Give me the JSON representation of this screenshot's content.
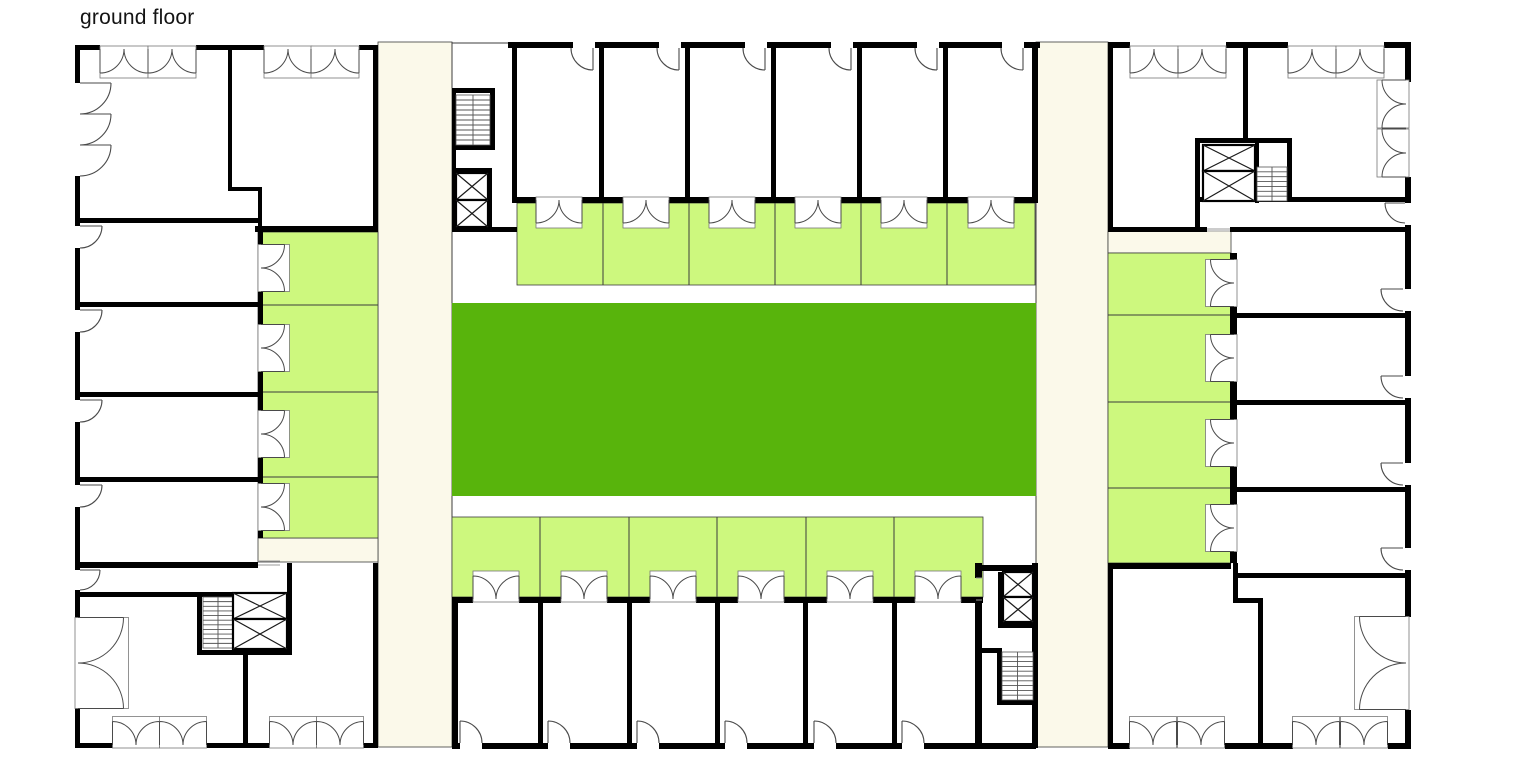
{
  "title": "ground floor",
  "canvas": {
    "width": 1536,
    "height": 780
  },
  "colors": {
    "street": "#fbf9ea",
    "terrace": "#cdf87e",
    "courtyard": "#58b40c",
    "wall": "#000000",
    "thin": "#3c3c3c",
    "door": "#4a4a4a",
    "sill": "#999999",
    "stair": "#555555",
    "title_text": "#141414"
  },
  "plan": {
    "fills": [
      [
        378,
        42,
        74,
        705,
        "street",
        1
      ],
      [
        1036,
        42,
        72,
        705,
        "street",
        1
      ],
      [
        258,
        538,
        120,
        24,
        "street",
        1
      ],
      [
        1108,
        231,
        123,
        22,
        "street",
        1
      ],
      [
        258,
        232,
        120,
        306,
        "terrace",
        1
      ],
      [
        1108,
        253,
        123,
        310,
        "terrace",
        1
      ],
      [
        517,
        203,
        518,
        82,
        "terrace",
        1
      ],
      [
        452,
        517,
        531,
        80,
        "terrace",
        1
      ],
      [
        452,
        303,
        584,
        193,
        "courtyard",
        0
      ]
    ],
    "thin_lines": [
      [
        258,
        305,
        378,
        305
      ],
      [
        258,
        392,
        378,
        392
      ],
      [
        258,
        477,
        378,
        477
      ],
      [
        1108,
        315,
        1231,
        315
      ],
      [
        1108,
        402,
        1231,
        402
      ],
      [
        1108,
        488,
        1231,
        488
      ],
      [
        603,
        203,
        603,
        285
      ],
      [
        689,
        203,
        689,
        285
      ],
      [
        775,
        203,
        775,
        285
      ],
      [
        861,
        203,
        861,
        285
      ],
      [
        947,
        203,
        947,
        285
      ],
      [
        540,
        517,
        540,
        597
      ],
      [
        629,
        517,
        629,
        597
      ],
      [
        717,
        517,
        717,
        597
      ],
      [
        806,
        517,
        806,
        597
      ],
      [
        894,
        517,
        894,
        597
      ],
      [
        452,
        42,
        452,
        88
      ],
      [
        452,
        232,
        452,
        303
      ],
      [
        452,
        496,
        452,
        517
      ],
      [
        1036,
        203,
        1036,
        303
      ],
      [
        1036,
        496,
        1036,
        563
      ],
      [
        452,
        43,
        512,
        43
      ]
    ],
    "walls": [
      [
        75,
        45,
        25,
        5
      ],
      [
        196,
        45,
        68,
        5
      ],
      [
        359,
        45,
        19,
        5
      ],
      [
        75,
        45,
        5,
        38
      ],
      [
        75,
        176,
        5,
        50
      ],
      [
        75,
        248,
        5,
        62
      ],
      [
        75,
        332,
        5,
        68
      ],
      [
        75,
        422,
        5,
        63
      ],
      [
        75,
        507,
        5,
        63
      ],
      [
        75,
        590,
        5,
        28
      ],
      [
        75,
        708,
        5,
        40
      ],
      [
        373,
        45,
        5,
        187
      ],
      [
        373,
        563,
        5,
        185
      ],
      [
        75,
        743,
        38,
        5
      ],
      [
        207,
        743,
        63,
        5
      ],
      [
        363,
        743,
        15,
        5
      ],
      [
        228,
        45,
        4,
        142
      ],
      [
        228,
        187,
        34,
        4
      ],
      [
        258,
        187,
        4,
        45
      ],
      [
        75,
        218,
        183,
        5
      ],
      [
        75,
        302,
        183,
        5
      ],
      [
        75,
        392,
        183,
        5
      ],
      [
        75,
        477,
        183,
        5
      ],
      [
        75,
        562,
        183,
        6
      ],
      [
        255,
        226,
        123,
        6
      ],
      [
        258,
        232,
        5,
        13
      ],
      [
        258,
        292,
        5,
        33
      ],
      [
        258,
        372,
        5,
        39
      ],
      [
        258,
        458,
        5,
        26
      ],
      [
        258,
        531,
        5,
        7
      ],
      [
        75,
        592,
        217,
        5
      ],
      [
        197,
        597,
        5,
        58
      ],
      [
        287,
        563,
        5,
        92
      ],
      [
        197,
        650,
        95,
        5
      ],
      [
        243,
        655,
        5,
        93
      ],
      [
        508,
        42,
        65,
        6
      ],
      [
        595,
        42,
        64,
        6
      ],
      [
        681,
        42,
        64,
        6
      ],
      [
        767,
        42,
        64,
        6
      ],
      [
        853,
        42,
        64,
        6
      ],
      [
        939,
        42,
        63,
        6
      ],
      [
        1024,
        42,
        16,
        6
      ],
      [
        512,
        42,
        5,
        161
      ],
      [
        1032,
        42,
        6,
        161
      ],
      [
        599,
        48,
        5,
        149
      ],
      [
        685,
        48,
        5,
        149
      ],
      [
        771,
        48,
        5,
        149
      ],
      [
        857,
        48,
        5,
        149
      ],
      [
        943,
        48,
        5,
        149
      ],
      [
        512,
        197,
        24,
        6
      ],
      [
        582,
        197,
        42,
        6
      ],
      [
        669,
        197,
        41,
        6
      ],
      [
        755,
        197,
        41,
        6
      ],
      [
        841,
        197,
        41,
        6
      ],
      [
        927,
        197,
        41,
        6
      ],
      [
        1014,
        197,
        24,
        6
      ],
      [
        452,
        88,
        38,
        5
      ],
      [
        452,
        88,
        4,
        144
      ],
      [
        490,
        88,
        5,
        62
      ],
      [
        456,
        145,
        39,
        5
      ],
      [
        452,
        168,
        40,
        4
      ],
      [
        488,
        168,
        4,
        64
      ],
      [
        452,
        227,
        65,
        5
      ],
      [
        538,
        603,
        5,
        142
      ],
      [
        627,
        603,
        5,
        142
      ],
      [
        715,
        603,
        5,
        142
      ],
      [
        803,
        603,
        5,
        142
      ],
      [
        892,
        603,
        5,
        142
      ],
      [
        452,
        597,
        21,
        6
      ],
      [
        519,
        597,
        42,
        6
      ],
      [
        607,
        597,
        43,
        6
      ],
      [
        696,
        597,
        42,
        6
      ],
      [
        784,
        597,
        43,
        6
      ],
      [
        873,
        597,
        42,
        6
      ],
      [
        961,
        597,
        22,
        6
      ],
      [
        452,
        597,
        6,
        151
      ],
      [
        452,
        743,
        8,
        6
      ],
      [
        482,
        743,
        66,
        6
      ],
      [
        570,
        743,
        67,
        6
      ],
      [
        659,
        743,
        66,
        6
      ],
      [
        747,
        743,
        67,
        6
      ],
      [
        836,
        743,
        66,
        6
      ],
      [
        924,
        743,
        112,
        6
      ],
      [
        975,
        563,
        7,
        15
      ],
      [
        975,
        600,
        7,
        148
      ],
      [
        975,
        565,
        62,
        6
      ],
      [
        998,
        572,
        5,
        56
      ],
      [
        998,
        623,
        39,
        5
      ],
      [
        997,
        648,
        5,
        57
      ],
      [
        978,
        648,
        24,
        5
      ],
      [
        997,
        700,
        40,
        5
      ],
      [
        1032,
        563,
        6,
        185
      ],
      [
        1108,
        42,
        22,
        6
      ],
      [
        1226,
        42,
        62,
        6
      ],
      [
        1384,
        42,
        26,
        6
      ],
      [
        1108,
        42,
        5,
        190
      ],
      [
        1108,
        563,
        5,
        185
      ],
      [
        1405,
        42,
        6,
        40
      ],
      [
        1405,
        177,
        6,
        26
      ],
      [
        1405,
        225,
        6,
        64
      ],
      [
        1405,
        311,
        6,
        65
      ],
      [
        1405,
        398,
        6,
        65
      ],
      [
        1405,
        485,
        6,
        63
      ],
      [
        1405,
        570,
        6,
        47
      ],
      [
        1405,
        710,
        6,
        38
      ],
      [
        1108,
        743,
        22,
        6
      ],
      [
        1225,
        743,
        68,
        6
      ],
      [
        1388,
        743,
        23,
        6
      ],
      [
        1243,
        42,
        5,
        96
      ],
      [
        1200,
        138,
        90,
        5
      ],
      [
        1195,
        138,
        5,
        94
      ],
      [
        1255,
        143,
        4,
        60
      ],
      [
        1287,
        138,
        5,
        64
      ],
      [
        1195,
        197,
        215,
        5
      ],
      [
        1108,
        227,
        99,
        5
      ],
      [
        1230,
        227,
        180,
        5
      ],
      [
        1230,
        253,
        7,
        7
      ],
      [
        1230,
        307,
        7,
        28
      ],
      [
        1230,
        382,
        7,
        38
      ],
      [
        1230,
        467,
        7,
        38
      ],
      [
        1230,
        552,
        7,
        11
      ],
      [
        1230,
        313,
        180,
        5
      ],
      [
        1230,
        400,
        180,
        5
      ],
      [
        1230,
        487,
        180,
        5
      ],
      [
        1108,
        563,
        123,
        6
      ],
      [
        1233,
        573,
        177,
        5
      ],
      [
        1233,
        563,
        5,
        40
      ],
      [
        1233,
        598,
        30,
        5
      ],
      [
        1258,
        603,
        5,
        142
      ]
    ],
    "stairs": [
      [
        456,
        95,
        34,
        50
      ],
      [
        203,
        597,
        30,
        51
      ],
      [
        1257,
        167,
        30,
        34
      ],
      [
        1002,
        652,
        31,
        48
      ]
    ],
    "elevators": [
      [
        456,
        173,
        32,
        27
      ],
      [
        456,
        200,
        32,
        27
      ],
      [
        233,
        593,
        54,
        26
      ],
      [
        233,
        619,
        54,
        30
      ],
      [
        1203,
        145,
        52,
        26
      ],
      [
        1203,
        171,
        52,
        30
      ],
      [
        1003,
        572,
        30,
        25
      ],
      [
        1003,
        597,
        30,
        25
      ]
    ],
    "doors_single": [
      [
        80,
        83,
        31,
        0,
        90
      ],
      [
        80,
        114,
        31,
        0,
        90
      ],
      [
        80,
        145,
        31,
        0,
        90
      ],
      [
        80,
        226,
        22,
        0,
        90
      ],
      [
        80,
        310,
        22,
        0,
        90
      ],
      [
        80,
        400,
        22,
        0,
        90
      ],
      [
        80,
        485,
        22,
        0,
        90
      ],
      [
        80,
        570,
        20,
        0,
        90
      ],
      [
        593,
        48,
        22,
        90,
        180
      ],
      [
        679,
        48,
        22,
        90,
        180
      ],
      [
        765,
        48,
        22,
        90,
        180
      ],
      [
        851,
        48,
        22,
        90,
        180
      ],
      [
        937,
        48,
        22,
        90,
        180
      ],
      [
        1023,
        48,
        22,
        90,
        180
      ],
      [
        460,
        743,
        22,
        270,
        360
      ],
      [
        548,
        743,
        22,
        270,
        360
      ],
      [
        637,
        743,
        22,
        270,
        360
      ],
      [
        725,
        743,
        22,
        270,
        360
      ],
      [
        814,
        743,
        22,
        270,
        360
      ],
      [
        902,
        743,
        22,
        270,
        360
      ],
      [
        1405,
        203,
        20,
        180,
        90
      ],
      [
        1403,
        289,
        22,
        180,
        90
      ],
      [
        1403,
        376,
        22,
        180,
        90
      ],
      [
        1403,
        463,
        22,
        180,
        90
      ],
      [
        1403,
        548,
        22,
        180,
        90
      ]
    ],
    "doors_double": [
      [
        124,
        49,
        "d",
        48
      ],
      [
        172,
        49,
        "d",
        48
      ],
      [
        288,
        49,
        "d",
        48
      ],
      [
        335,
        49,
        "d",
        48
      ],
      [
        1154,
        49,
        "d",
        48
      ],
      [
        1202,
        49,
        "d",
        48
      ],
      [
        1312,
        49,
        "d",
        48
      ],
      [
        1360,
        49,
        "d",
        48
      ],
      [
        559,
        200,
        "d",
        46
      ],
      [
        646,
        200,
        "d",
        46
      ],
      [
        732,
        200,
        "d",
        46
      ],
      [
        818,
        200,
        "d",
        46
      ],
      [
        904,
        200,
        "d",
        46
      ],
      [
        991,
        200,
        "d",
        46
      ],
      [
        496,
        599,
        "u",
        46
      ],
      [
        584,
        599,
        "u",
        46
      ],
      [
        673,
        599,
        "u",
        46
      ],
      [
        761,
        599,
        "u",
        46
      ],
      [
        850,
        599,
        "u",
        46
      ],
      [
        938,
        599,
        "u",
        46
      ],
      [
        261,
        268,
        "r",
        47
      ],
      [
        261,
        348,
        "r",
        47
      ],
      [
        261,
        434,
        "r",
        47
      ],
      [
        261,
        507,
        "r",
        47
      ],
      [
        1234,
        283,
        "l",
        47
      ],
      [
        1234,
        358,
        "l",
        47
      ],
      [
        1234,
        443,
        "l",
        47
      ],
      [
        1234,
        528,
        "l",
        47
      ],
      [
        78,
        663,
        "r",
        91
      ],
      [
        136,
        745,
        "u",
        47
      ],
      [
        183,
        745,
        "u",
        47
      ],
      [
        293,
        745,
        "u",
        47
      ],
      [
        340,
        745,
        "u",
        47
      ],
      [
        1406,
        104,
        "l",
        48
      ],
      [
        1406,
        153,
        "l",
        48
      ],
      [
        1406,
        663,
        "l",
        93
      ],
      [
        1153,
        745,
        "u",
        47
      ],
      [
        1201,
        745,
        "u",
        47
      ],
      [
        1316,
        745,
        "u",
        47
      ],
      [
        1364,
        745,
        "u",
        47
      ]
    ],
    "sills": [
      [
        258,
        561,
        280,
        561
      ],
      [
        258,
        565,
        280,
        565
      ],
      [
        1207,
        229,
        1230,
        229
      ],
      [
        1207,
        231,
        1230,
        231
      ],
      [
        976,
        578,
        982,
        578
      ],
      [
        976,
        600,
        982,
        600
      ]
    ]
  }
}
